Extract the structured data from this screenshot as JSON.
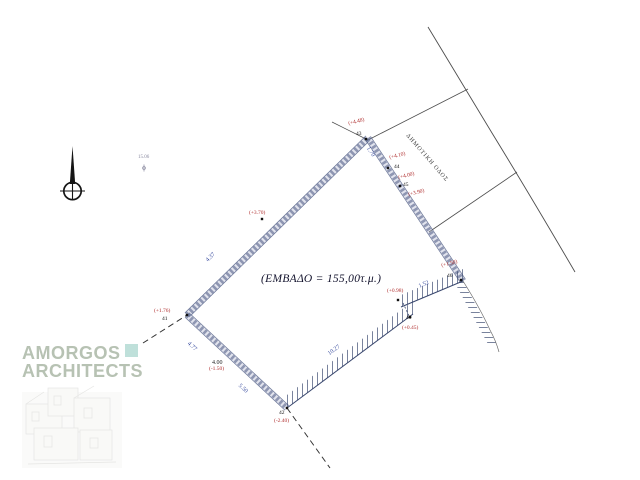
{
  "area_label": "(ΕΜΒΑΔΟ = 155,00τ.μ.)",
  "road_label": "ΔΗΜΟΤΙΚΗ ΟΔΟΣ",
  "watermark": {
    "line1": "AMORGOS",
    "line2": "ARCHITECTS"
  },
  "north_marker": {
    "label": "15.06"
  },
  "survey_points": [
    {
      "id": "43",
      "elevation": "(+4.48)"
    },
    {
      "id": "44",
      "elevation": "(+4.10)"
    },
    {
      "id": "45",
      "elevation": "(+4.00)"
    },
    {
      "id": "46",
      "elevation": "(+1.50)"
    },
    {
      "id": "40",
      "elevation": "(+0.45)"
    },
    {
      "id": "41",
      "elevation": "(+1.76)"
    },
    {
      "id": "42",
      "elevation": "(-2.40)"
    }
  ],
  "spot_elevations": [
    "(+3.90)",
    "(+0.98)",
    "(+3.70)",
    "(-1.50)"
  ],
  "dimensions": {
    "nw": "4.37",
    "ne_top": "1.70",
    "se_short": "1.52",
    "se_long": "10.27",
    "sw_upper": "4.77",
    "sw_mid": "4.00",
    "sw_lower": "5.50"
  },
  "colors": {
    "wall": "#3d4b78",
    "red_label": "#b03030",
    "blue_label": "#3b4ea0",
    "watermark_text": "#b7c2b3",
    "watermark_square": "#bfe0da"
  }
}
